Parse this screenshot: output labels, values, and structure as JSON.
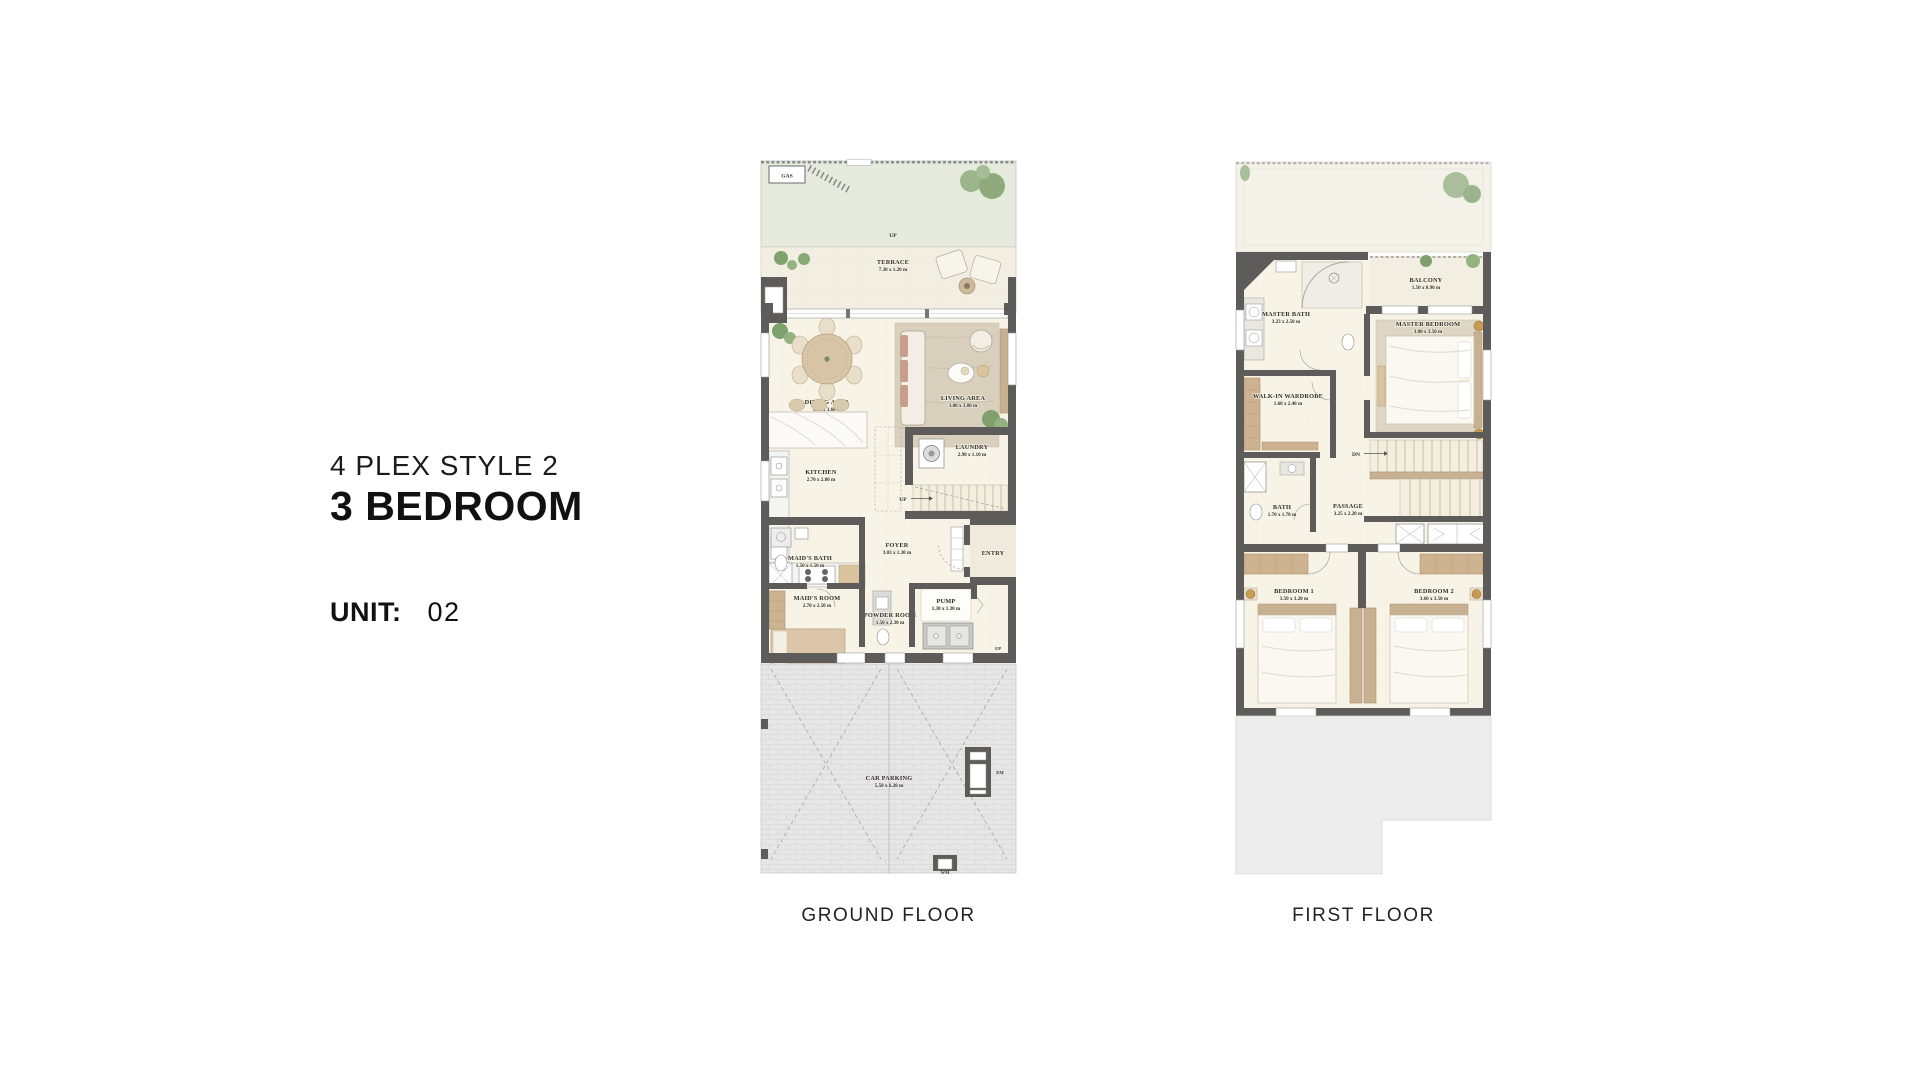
{
  "palette": {
    "wall": "#5d5c5a",
    "floor_cream": "#f7f3e7",
    "garden_green": "#e6ebdd",
    "terrace_beige": "#f2eee1",
    "parking_gray": "#e6e6e6",
    "roof_gray": "#ededed",
    "wood": "#c8b191",
    "plant_green": "#8fab7d",
    "text_dark": "#111111"
  },
  "title": {
    "style_line": "4 PLEX STYLE 2",
    "bedrooms_line": "3 BEDROOM"
  },
  "unit": {
    "label": "UNIT:",
    "number": "02"
  },
  "ground_floor": {
    "caption": "GROUND FLOOR",
    "markers": {
      "gas": "GAS",
      "garden_up": "UP",
      "stair_up": "UP",
      "entry": "ENTRY",
      "entry_up": "UP",
      "em": "EM",
      "wm": "WM"
    },
    "rooms": {
      "terrace": {
        "name": "TERRACE",
        "dims": "7.30 x 1.20 m"
      },
      "dining": {
        "name": "DINING AREA",
        "dims": "3.40 x 3.60 m"
      },
      "living": {
        "name": "LIVING AREA",
        "dims": "3.80 x 3.80 m"
      },
      "kitchen": {
        "name": "KITCHEN",
        "dims": "2.70 x 2.80 m"
      },
      "laundry": {
        "name": "LAUNDRY",
        "dims": "2.90 x 1.10 m"
      },
      "maids_bath": {
        "name": "MAID'S BATH",
        "dims": "1.50 x 1.50 m"
      },
      "maids_room": {
        "name": "MAID'S ROOM",
        "dims": "2.70 x 2.50 m"
      },
      "powder": {
        "name": "POWDER ROOM",
        "dims": "1.50 x 2.30 m"
      },
      "foyer": {
        "name": "FOYER",
        "dims": "3.03 x 1.30 m"
      },
      "pump": {
        "name": "PUMP",
        "dims": "1.30 x 1.30 m"
      },
      "parking": {
        "name": "CAR PARKING",
        "dims": "5.50 x 6.20 m"
      }
    }
  },
  "first_floor": {
    "caption": "FIRST FLOOR",
    "markers": {
      "dn": "DN"
    },
    "rooms": {
      "master_bath": {
        "name": "MASTER BATH",
        "dims": "3.23 x 2.50 m"
      },
      "balcony": {
        "name": "BALCONY",
        "dims": "1.50 x 0.90 m"
      },
      "master_bedroom": {
        "name": "MASTER BEDROOM",
        "dims": "3.80 x 3.50 m"
      },
      "wardrobe": {
        "name": "WALK-IN WARDROBE",
        "dims": "1.60 x 2.40 m"
      },
      "bath": {
        "name": "BATH",
        "dims": "1.70 x 1.70 m"
      },
      "passage": {
        "name": "PASSAGE",
        "dims": "3.25 x 2.20 m"
      },
      "bedroom1": {
        "name": "BEDROOM 1",
        "dims": "3.50 x 3.20 m"
      },
      "bedroom2": {
        "name": "BEDROOM 2",
        "dims": "3.60 x 3.50 m"
      }
    }
  }
}
